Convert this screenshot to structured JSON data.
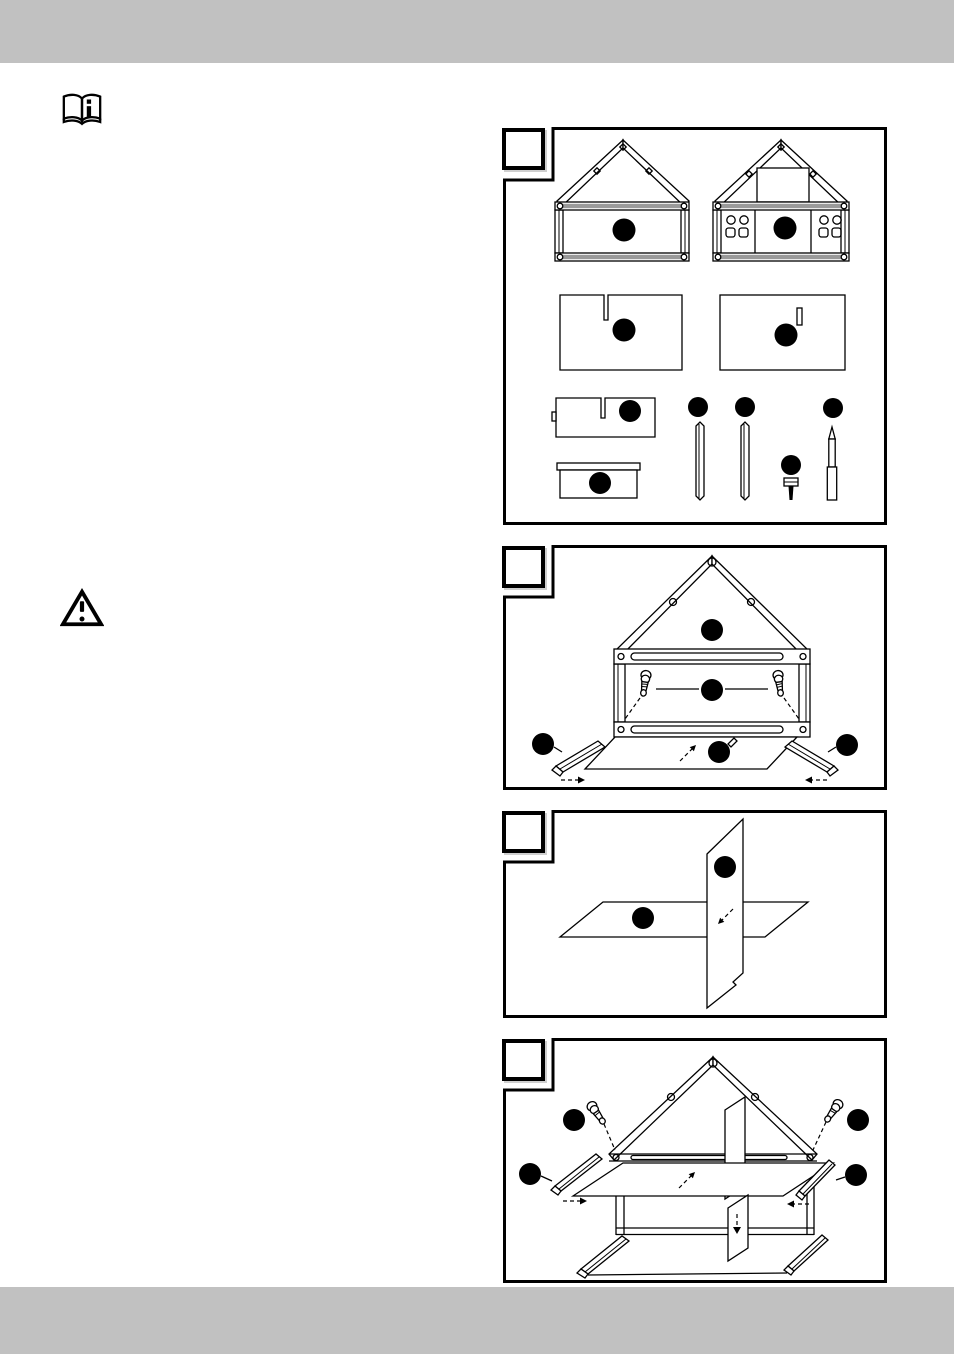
{
  "page": {
    "background": "#ffffff",
    "bar_color": "#c1c1c1",
    "ink_color": "#000000"
  },
  "icons": {
    "manual_label": "read-instruction-manual-icon",
    "warning_label": "warning-triangle-icon"
  },
  "steps": [
    {
      "number": "",
      "name": "parts-overview",
      "callouts": 10,
      "parts": [
        "house-front-frame",
        "house-back-frame-with-holes",
        "panel-with-long-slot",
        "panel-with-short-slot",
        "small-panel-with-slot",
        "base-tray",
        "square-dowel",
        "square-dowel",
        "screw",
        "pencil"
      ]
    },
    {
      "number": "",
      "name": "attach-screws-and-slide-in-base",
      "callouts": 5
    },
    {
      "number": "",
      "name": "join-cross-panels",
      "callouts": 2
    },
    {
      "number": "",
      "name": "insert-cross-panels-into-frame",
      "callouts": 4
    }
  ]
}
